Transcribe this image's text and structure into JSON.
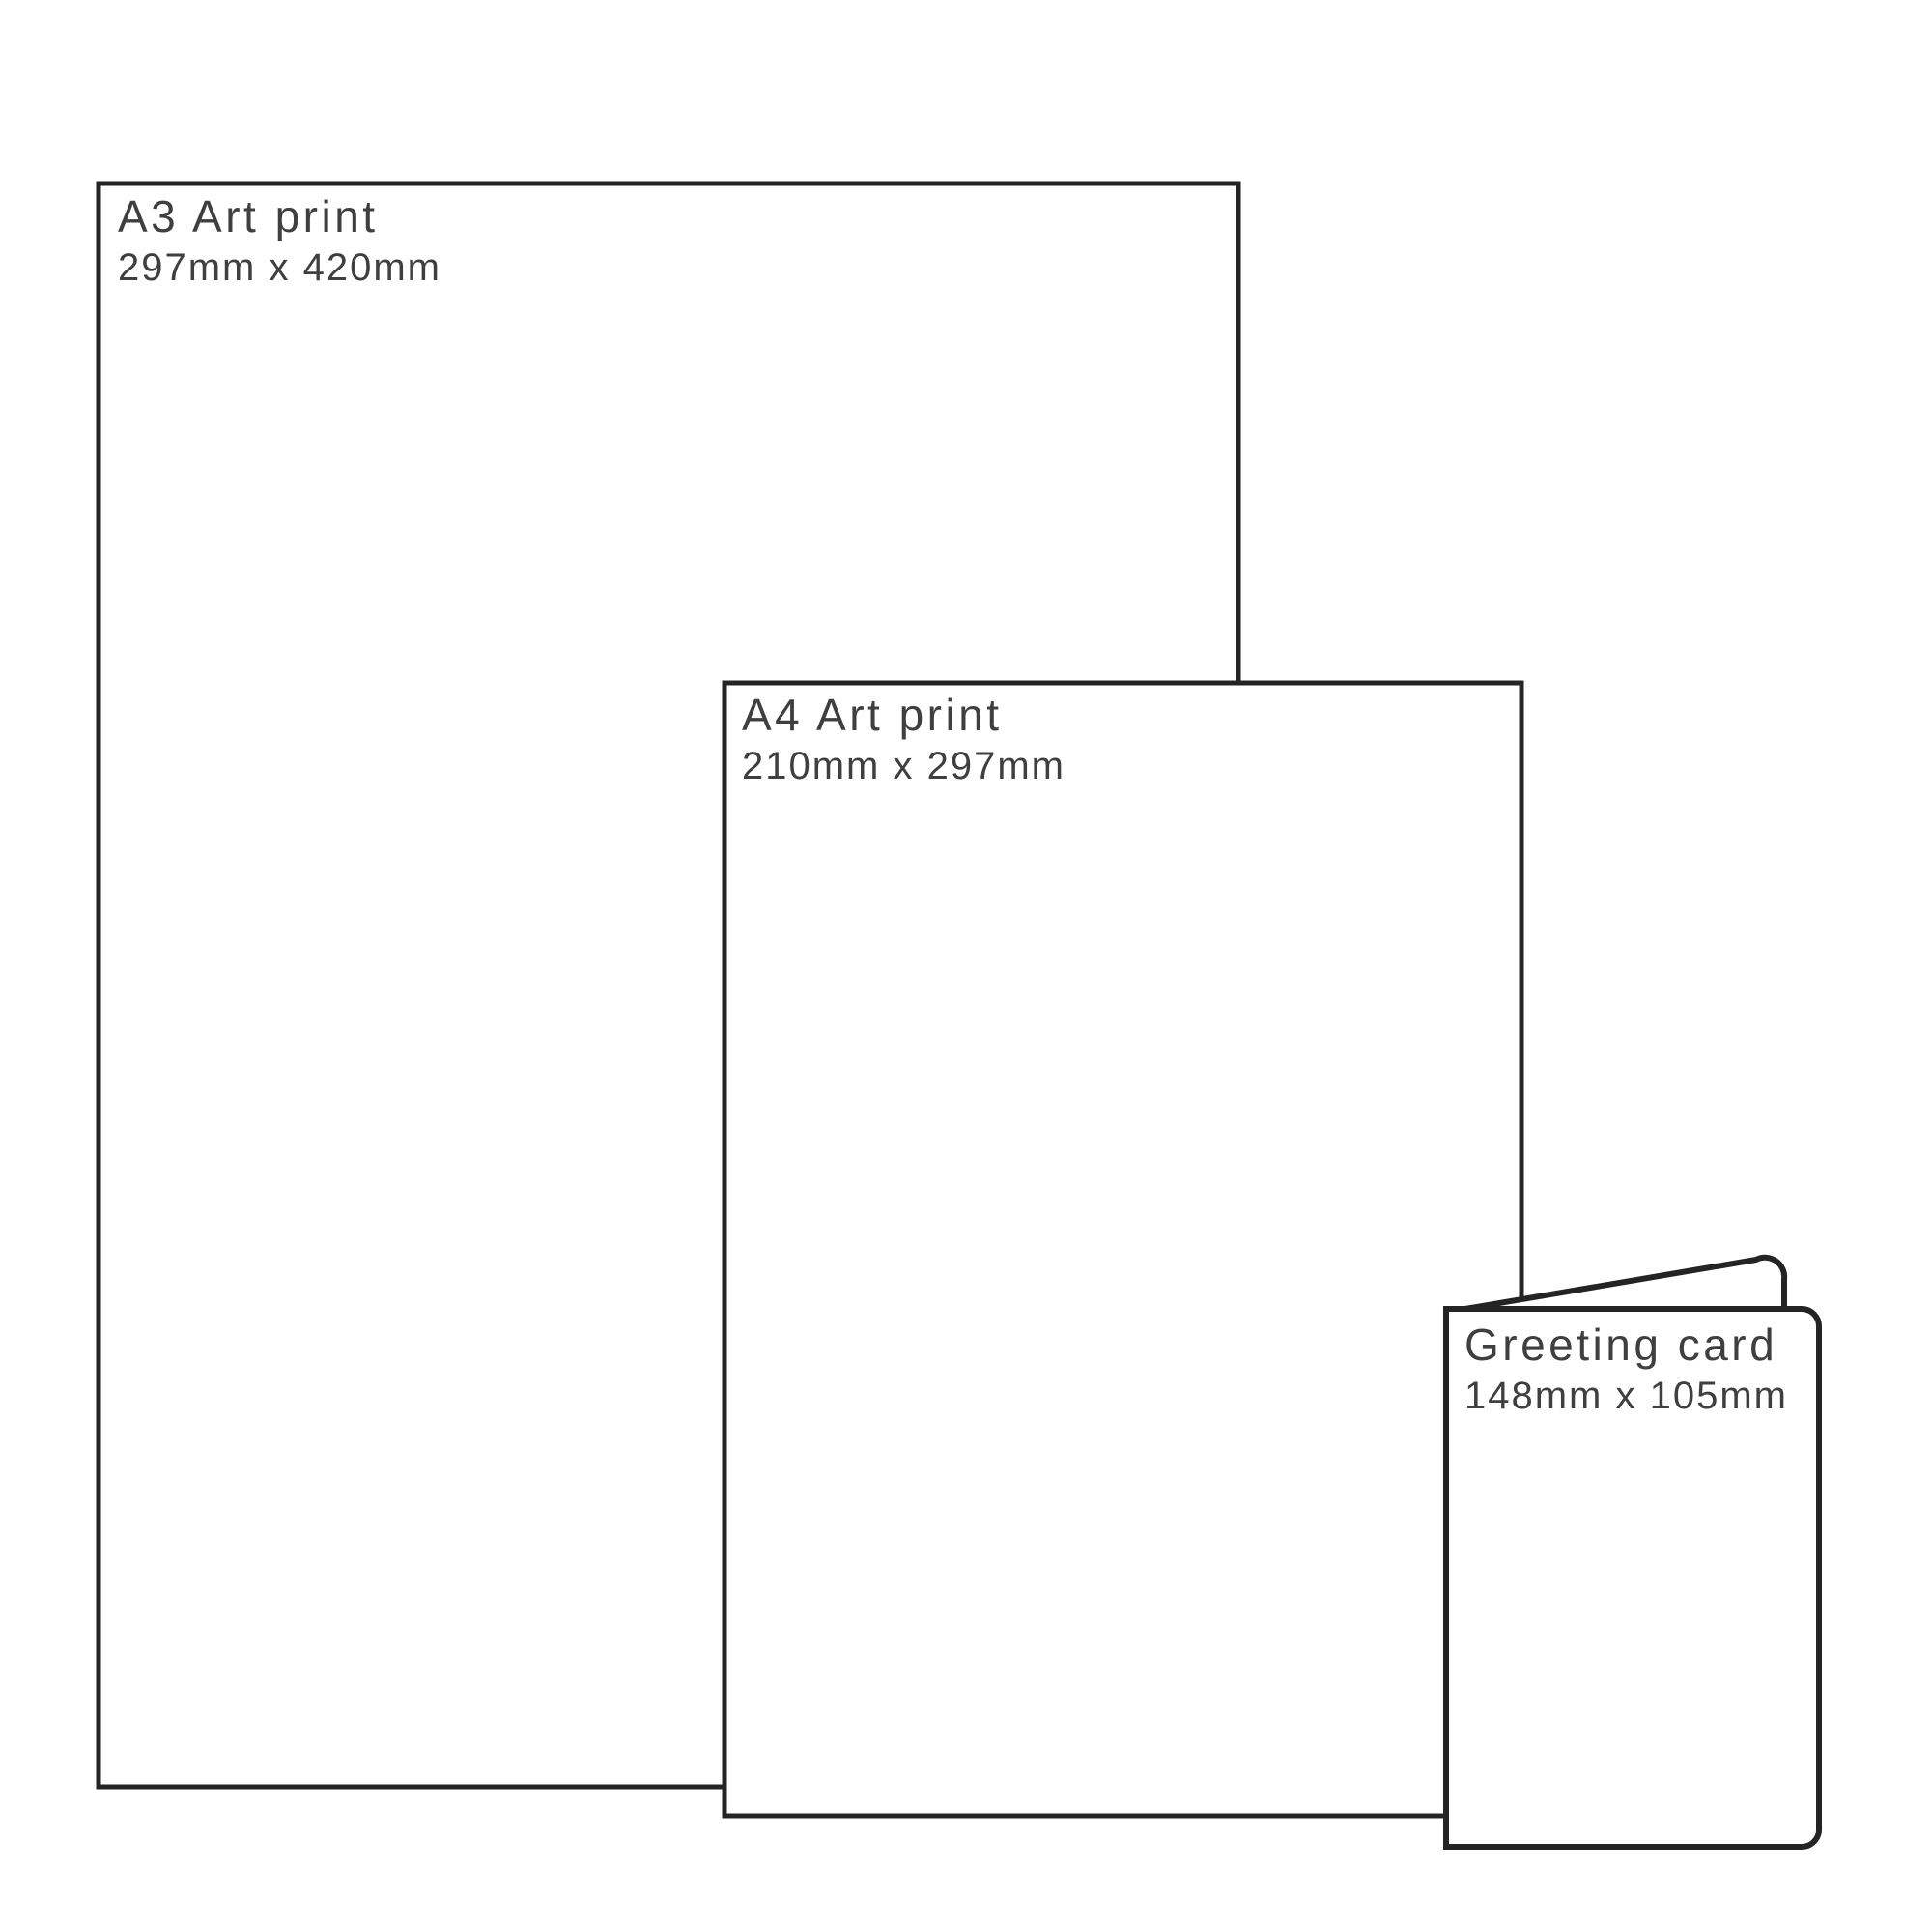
{
  "diagram": {
    "description": "Print size comparison diagram",
    "colors": {
      "outline": "#242424",
      "label_text": "#3f3f3f",
      "fill": "#ffffff",
      "background": "#ffffff"
    },
    "items": [
      {
        "id": "a3-print",
        "title": "A3 Art print",
        "dimensions": "297mm x 420mm"
      },
      {
        "id": "a4-print",
        "title": "A4 Art print",
        "dimensions": "210mm x 297mm"
      },
      {
        "id": "greeting-card",
        "title": "Greeting card",
        "dimensions": "148mm x 105mm"
      }
    ]
  }
}
